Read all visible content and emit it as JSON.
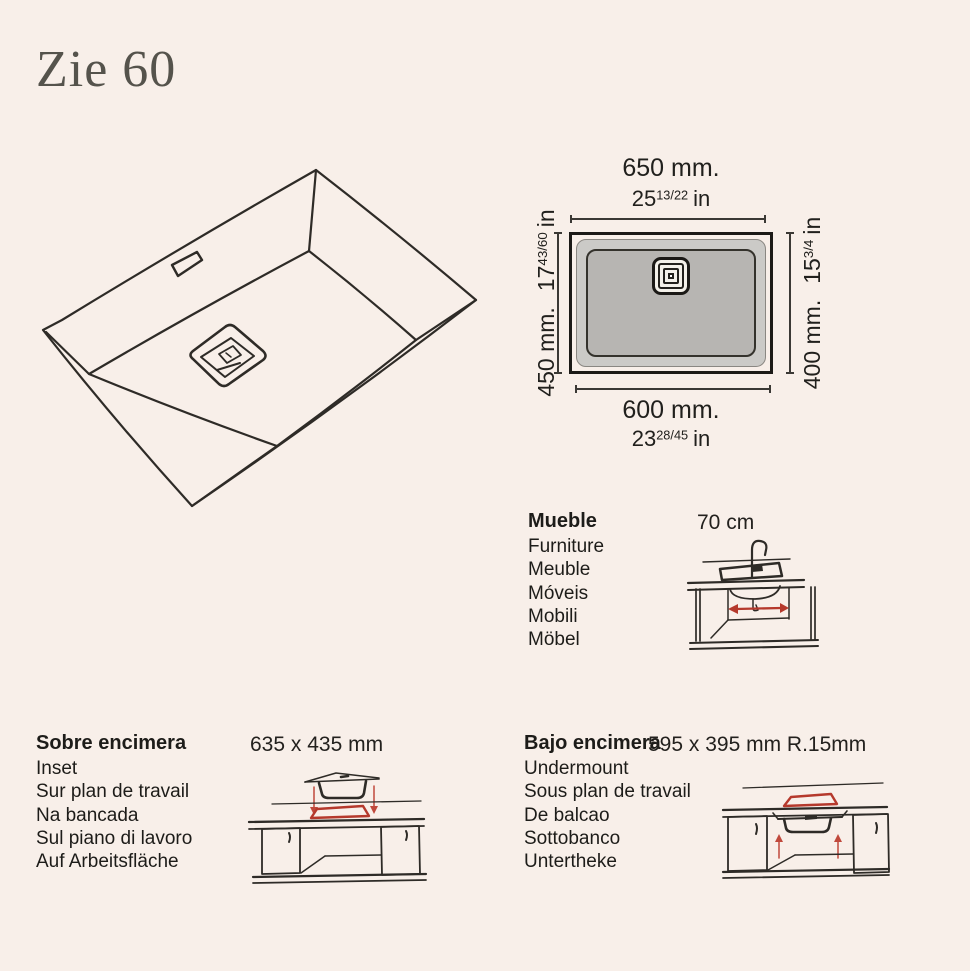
{
  "title": "Zie 60",
  "colors": {
    "background": "#f8efe9",
    "ink": "#2e2b27",
    "accent_red": "#b5392c",
    "rim_gray": "#cbcac7",
    "basin_gray": "#b7b5b2"
  },
  "top_view": {
    "top_mm": "650 mm.",
    "top_in_whole": "25",
    "top_in_frac": "13/22",
    "top_in_unit": "in",
    "bottom_mm": "600 mm.",
    "bottom_in_whole": "23",
    "bottom_in_frac": "28/45",
    "bottom_in_unit": "in",
    "left_mm": "450 mm.",
    "left_in_whole": "17",
    "left_in_frac": "43/60",
    "left_in_unit": "in",
    "right_mm": "400 mm.",
    "right_in_whole": "15",
    "right_in_frac": "3/4",
    "right_in_unit": "in"
  },
  "furniture": {
    "labels": [
      "Mueble",
      "Furniture",
      "Meuble",
      "Móveis",
      "Mobili",
      "Möbel"
    ],
    "dimension": "70 cm"
  },
  "inset": {
    "labels": [
      "Sobre encimera",
      "Inset",
      "Sur plan de travail",
      "Na bancada",
      "Sul piano di lavoro",
      "Auf Arbeitsfläche"
    ],
    "dimension": "635 x 435 mm"
  },
  "undermount": {
    "labels": [
      "Bajo encimera",
      "Undermount",
      "Sous plan de travail",
      "De balcao",
      "Sottobanco",
      "Untertheke"
    ],
    "dimension": "595 x 395 mm R.15mm"
  }
}
